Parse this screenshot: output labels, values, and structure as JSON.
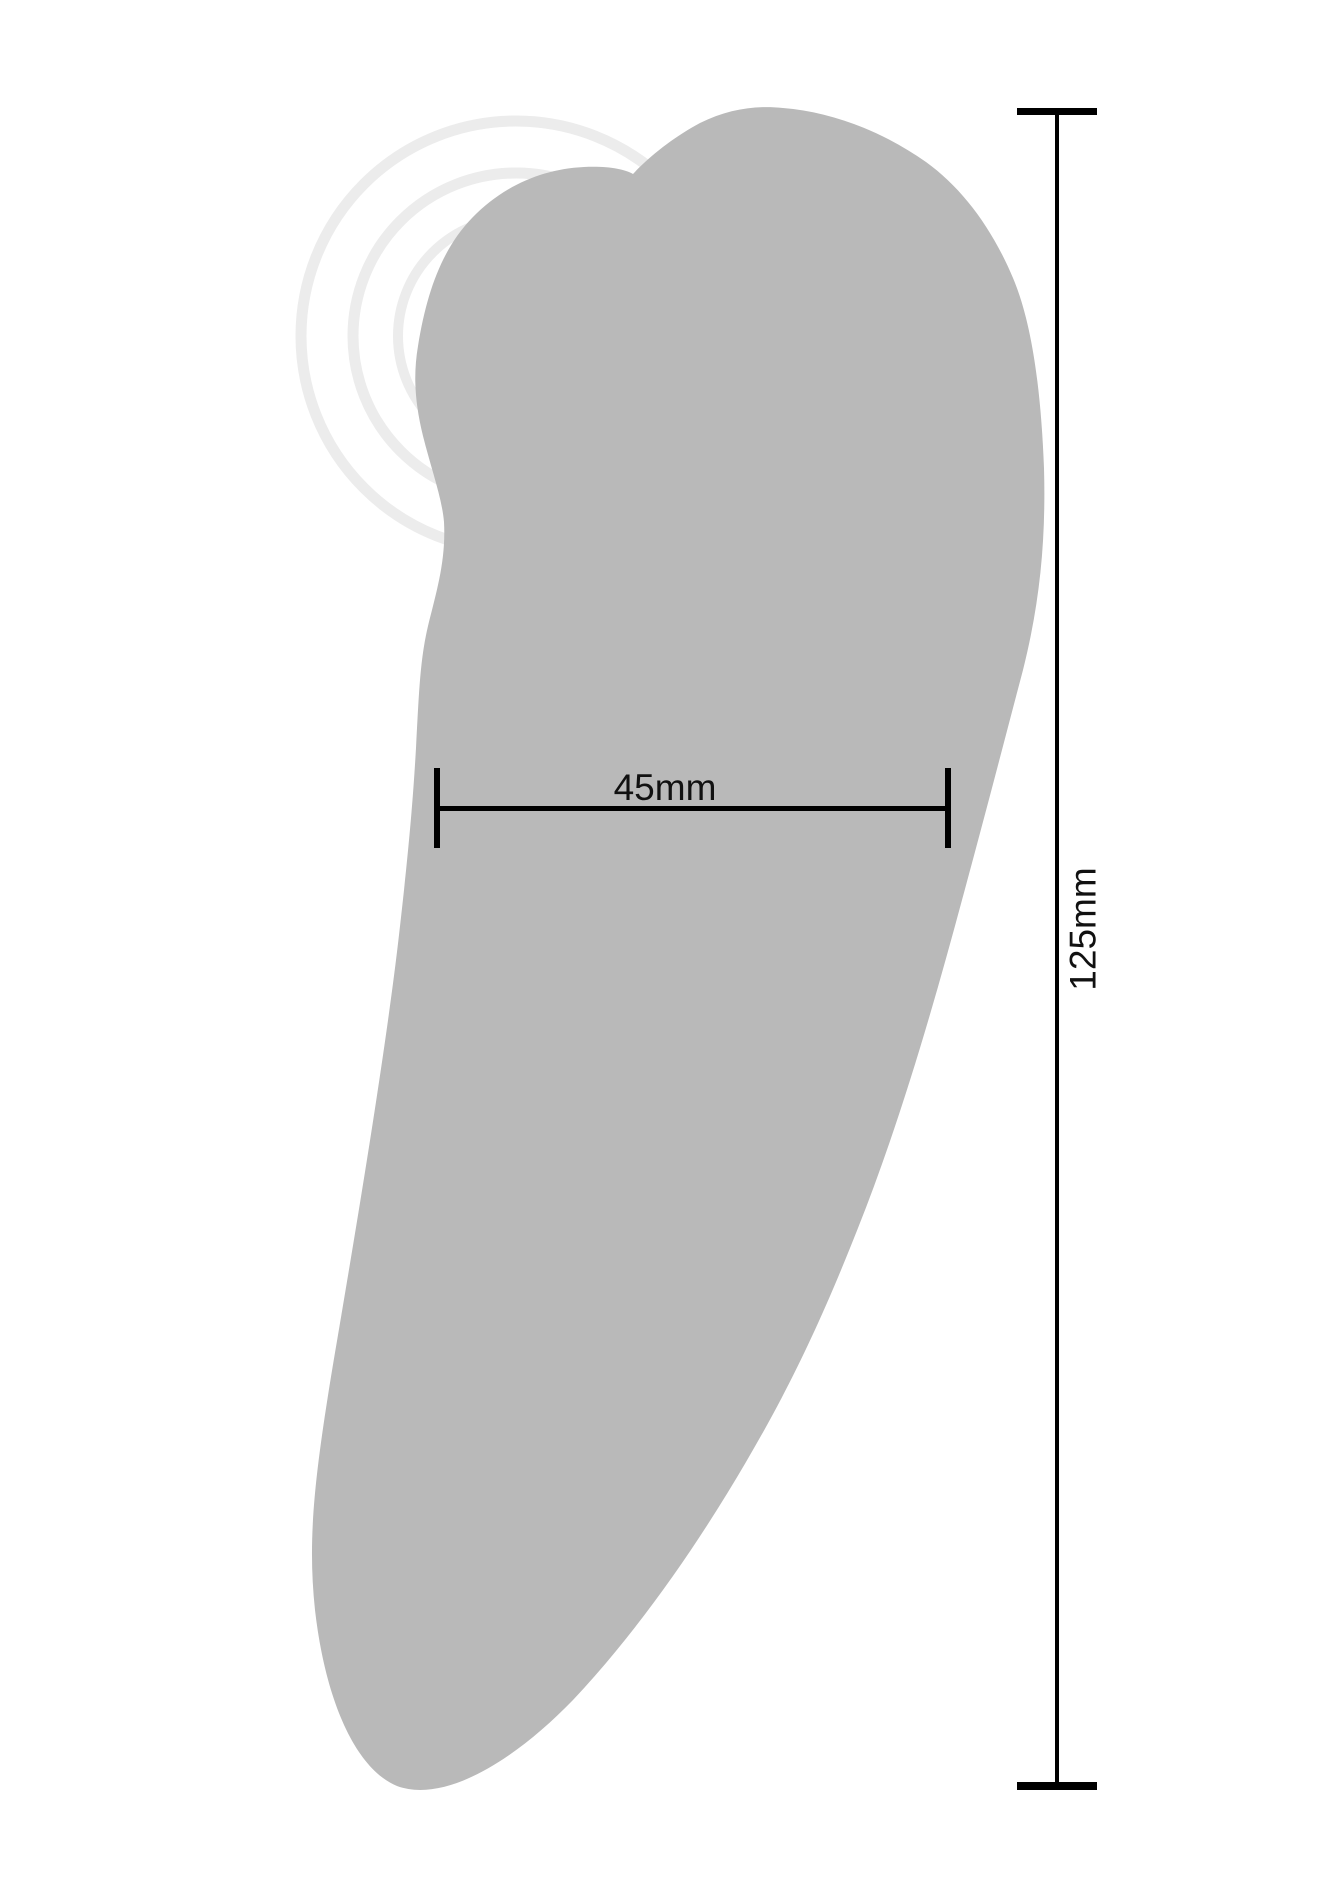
{
  "figure": {
    "type": "product-dimension-diagram",
    "background_color": "#ffffff",
    "product_silhouette": {
      "description": "gray side-profile silhouette of a lay-on massager with rounded head",
      "fill_color": "#b9b9b9"
    },
    "vibration_waves": {
      "count": 4,
      "color": "#ececec",
      "position": "upper-left around stimulation head"
    },
    "dimension_width": {
      "label": "45mm"
    },
    "dimension_height": {
      "label": "125mm"
    },
    "dimension_line_color": "#000000",
    "label_text_color": "#111111"
  }
}
